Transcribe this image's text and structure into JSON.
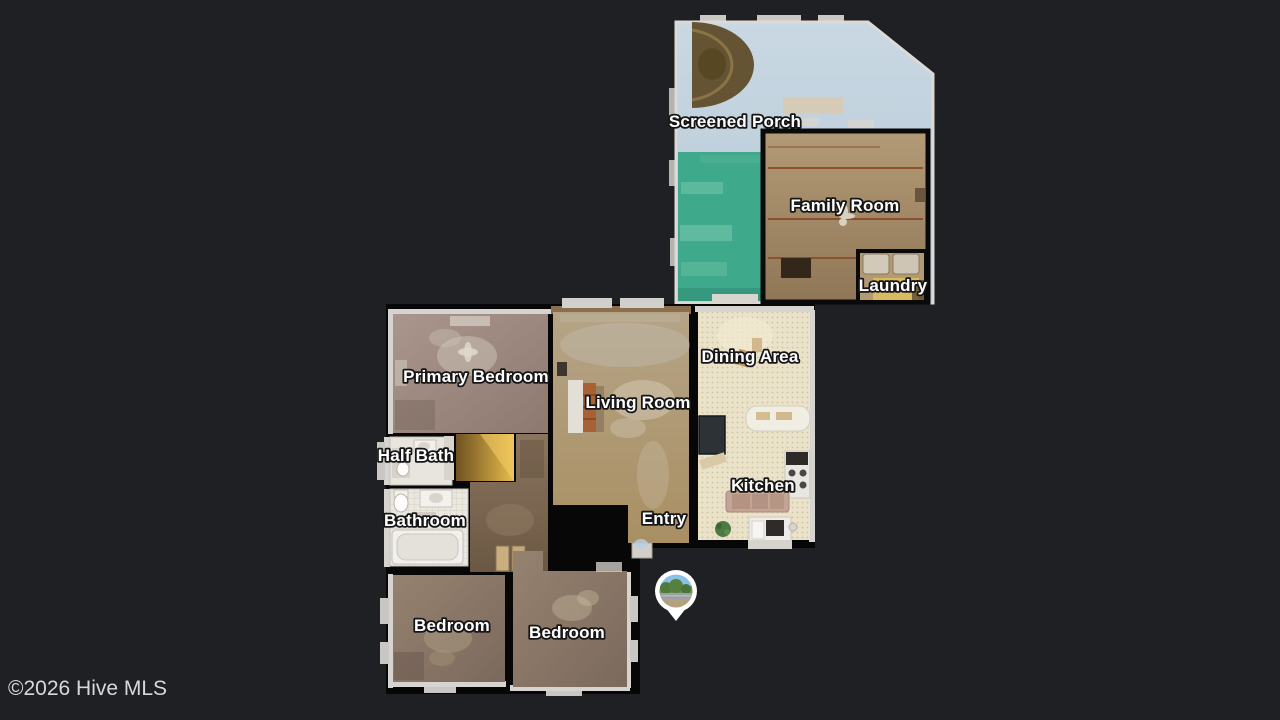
{
  "page": {
    "background_color": "#1f2023",
    "type_hint": "MLS listing floor plan viewer"
  },
  "watermark": {
    "text": "©2026 Hive MLS"
  },
  "floorplan": {
    "rooms": [
      {
        "id": "screened-porch",
        "label": "Screened Porch"
      },
      {
        "id": "family-room",
        "label": "Family Room"
      },
      {
        "id": "laundry",
        "label": "Laundry"
      },
      {
        "id": "primary-bedroom",
        "label": "Primary Bedroom"
      },
      {
        "id": "living-room",
        "label": "Living Room"
      },
      {
        "id": "dining-area",
        "label": "Dining Area"
      },
      {
        "id": "half-bath",
        "label": "Half Bath"
      },
      {
        "id": "kitchen",
        "label": "Kitchen"
      },
      {
        "id": "bathroom",
        "label": "Bathroom"
      },
      {
        "id": "entry",
        "label": "Entry"
      },
      {
        "id": "bedroom-left",
        "label": "Bedroom"
      },
      {
        "id": "bedroom-right",
        "label": "Bedroom"
      }
    ],
    "marker": {
      "icon": "panorama-pin-icon",
      "scene_colors": {
        "sky": "#8cc1e6",
        "trees": "#4f7a3b",
        "road": "#9aa0a3",
        "ground": "#b3a27f"
      }
    },
    "colors": {
      "background": "#1f2023",
      "interior_wall": "#070707",
      "exterior_wall": "#d6d4d0",
      "porch_floor": "#c4d4e0",
      "porch_carpet_green": "#3fa98c",
      "family_room_floor": "#a58c6b",
      "living_room_floor": "#b0986e",
      "primary_bedroom_floor": "#9d8a80",
      "bedroom_floor": "#8d7a6d",
      "tile_floor": "#eae2c9",
      "hallway_floor": "#7e6a56",
      "bathroom_floor": "#eae7e1",
      "closet_floor": "#d8ae42",
      "label_text": "#ffffff",
      "watermark_text": "#d8d8d8"
    }
  }
}
